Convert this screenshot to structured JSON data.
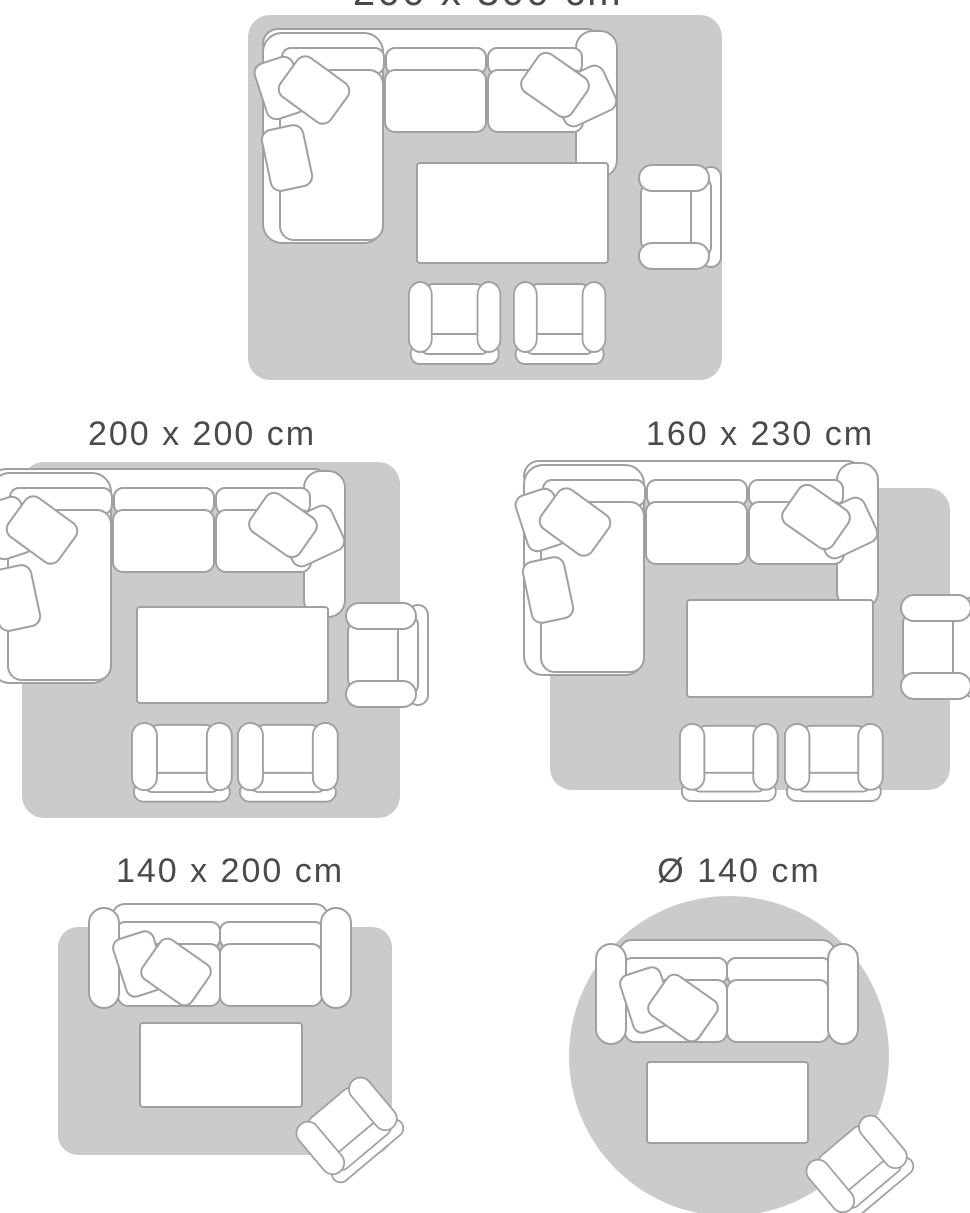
{
  "page": {
    "title": "Rug size guide",
    "background": "#ffffff"
  },
  "palette": {
    "rug_fill": "#cbcbcb",
    "furniture_fill": "#ffffff",
    "furniture_outline": "#a0a0a0",
    "label_color": "#4a4a4a"
  },
  "diagrams": [
    {
      "label": "200 x 300 cm",
      "rug_shape": "rectangle",
      "label_cut_off_at_top": true,
      "furniture": [
        "corner-sofa-with-cushions",
        "coffee-table",
        "armchair-right",
        "club-chair",
        "club-chair"
      ]
    },
    {
      "label": "200 x 200 cm",
      "rug_shape": "square",
      "label_cut_off_at_top": false,
      "furniture": [
        "corner-sofa-with-cushions",
        "coffee-table",
        "armchair-right",
        "club-chair",
        "club-chair"
      ]
    },
    {
      "label": "160 x 230 cm",
      "rug_shape": "rectangle",
      "label_cut_off_at_top": false,
      "furniture": [
        "corner-sofa-with-cushions",
        "coffee-table",
        "armchair-right",
        "club-chair",
        "club-chair"
      ]
    },
    {
      "label": "140 x 200 cm",
      "rug_shape": "rectangle",
      "label_cut_off_at_top": false,
      "furniture": [
        "two-seat-sofa-with-cushions",
        "coffee-table",
        "tilted-armchair"
      ]
    },
    {
      "label": "Ø 140 cm",
      "rug_shape": "circle",
      "label_cut_off_at_top": false,
      "furniture": [
        "two-seat-sofa-with-cushions",
        "coffee-table",
        "tilted-armchair"
      ]
    }
  ]
}
